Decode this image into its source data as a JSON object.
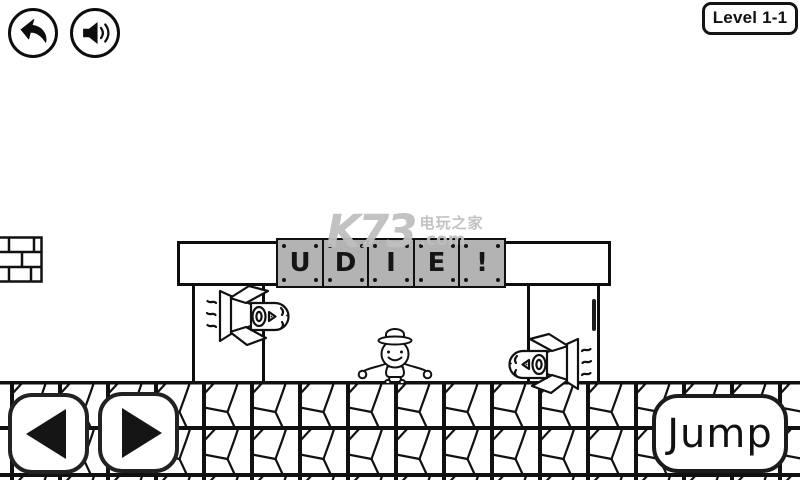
{
  "hud": {
    "level_label": "Level 1-1",
    "icons": {
      "back": "back-arrow",
      "sound": "speaker-with-waves"
    }
  },
  "watermark": {
    "logo": "K73",
    "site_name": "电玩之家",
    "domain": ".com"
  },
  "sign": {
    "letters": [
      "U",
      "D",
      "I",
      "E",
      "!"
    ]
  },
  "controls": {
    "jump_label": "Jump",
    "icons": {
      "move_left": "triangle-left",
      "move_right": "triangle-right"
    }
  },
  "colors": {
    "ink": "#111111",
    "block_gray": "#b3b3b3",
    "watermark_gray": "#bfbfbf",
    "background": "#ffffff"
  }
}
